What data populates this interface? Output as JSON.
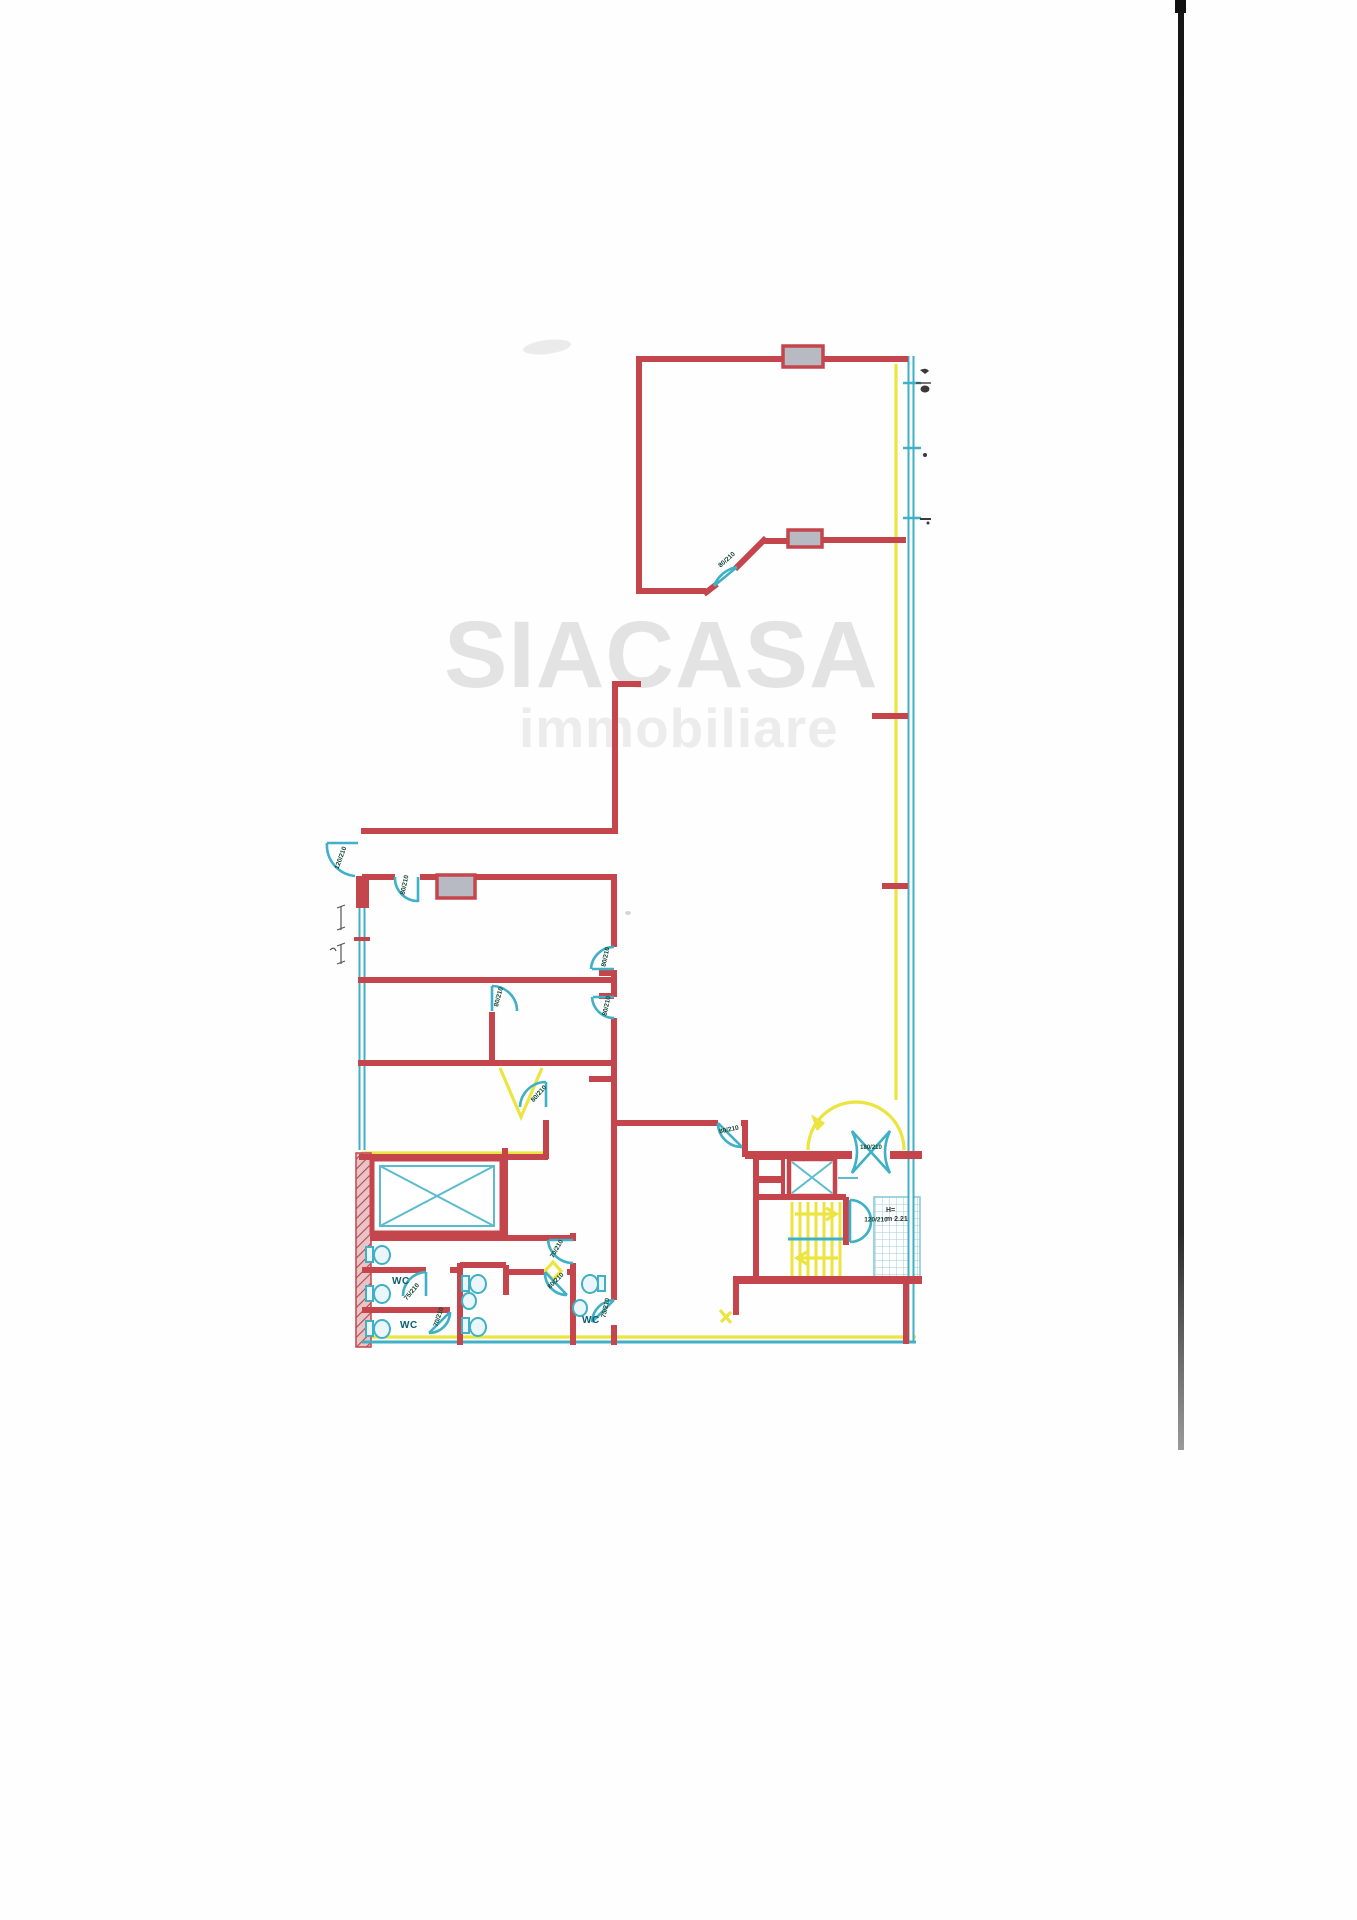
{
  "watermark": {
    "line1": "SIACASA",
    "line2": "immobiliare"
  },
  "labels": {
    "door_labels": [
      {
        "text": "80/210"
      },
      {
        "text": "120/210"
      },
      {
        "text": "80/210"
      },
      {
        "text": "80/210"
      },
      {
        "text": "80/210"
      },
      {
        "text": "80/210"
      },
      {
        "text": "80/210"
      },
      {
        "text": "80/210"
      },
      {
        "text": "180/210"
      },
      {
        "text": "120/210"
      },
      {
        "text": "70/210"
      },
      {
        "text": "80/210"
      },
      {
        "text": "75/210"
      },
      {
        "text": "70/210"
      },
      {
        "text": "75/210"
      }
    ],
    "room_labels": [
      {
        "text": "WC"
      },
      {
        "text": "WC"
      },
      {
        "text": "WC"
      }
    ],
    "height_note": {
      "line1": "H=",
      "line2": "m 2.21"
    }
  },
  "colors": {
    "wall_red": "#c4454c",
    "fixture_cyan": "#3fb0c6",
    "route_yellow": "#ece43f",
    "window_gray": "#b7bac3",
    "watermark_gray": "#e3e3e3",
    "scanner_line_black": "#1a1a1a"
  }
}
